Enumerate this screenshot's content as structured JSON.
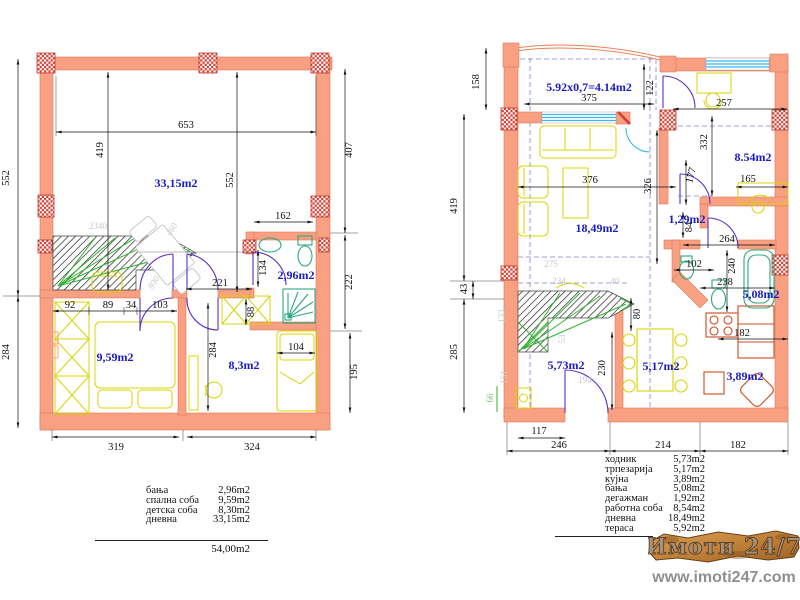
{
  "left": {
    "rooms": {
      "living": "33,15m2",
      "bath": "2,96m2",
      "bedroom": "9,59m2",
      "kids": "8,3m2"
    },
    "dims": {
      "w653": "653",
      "h419": "419",
      "h552a": "552",
      "h552b": "552",
      "h407": "407",
      "w162": "162",
      "h134": "134",
      "w221": "221",
      "h222": "222",
      "w92": "92",
      "w89": "89",
      "w34": "34",
      "w103": "103",
      "h88": "88",
      "h284a": "284",
      "h284b": "284",
      "w104": "104",
      "h195": "195",
      "w319": "319",
      "w324": "324"
    },
    "faint": {
      "f2340": "2340",
      "f460": "460",
      "f890": "890"
    },
    "legend": {
      "rows": [
        {
          "label": "бања",
          "value": "2,96m2"
        },
        {
          "label": "спална соба",
          "value": "9,59m2"
        },
        {
          "label": "детска соба",
          "value": "8,30m2"
        },
        {
          "label": "дневна",
          "value": "33,15m2"
        }
      ],
      "total": "54,00m2"
    }
  },
  "right": {
    "rooms": {
      "terrace": "5.92x0,7=4.14m2",
      "living": "18,49m2",
      "office": "8.54m2",
      "lobby": "1,29m2",
      "bath": "5,08m2",
      "kitchen": "3,89m2",
      "dining": "5,17m2",
      "hall": "5,73m2"
    },
    "dims": {
      "h158": "158",
      "w375": "375",
      "h122": "122",
      "w257": "257",
      "h332": "332",
      "h419": "419",
      "h43": "43",
      "h285": "285",
      "h66": "66",
      "w376": "376",
      "h326": "326",
      "h177": "177",
      "w165": "165",
      "h84": "84",
      "w264": "264",
      "w102": "102",
      "h240": "240",
      "w238": "238",
      "w182k": "182",
      "h80": "80",
      "h230": "230",
      "w117": "117",
      "w246": "246",
      "w214": "214",
      "w182b": "182"
    },
    "faint": {
      "f275": "275",
      "f234": "234",
      "f40": "40",
      "f133": "133",
      "f151": "151",
      "f53": "53",
      "f194": "194"
    },
    "legend": {
      "rows": [
        {
          "label": "ходник",
          "value": "5,73m2"
        },
        {
          "label": "трпезарија",
          "value": "5,17m2"
        },
        {
          "label": "кујна",
          "value": "3,89m2"
        },
        {
          "label": "бања",
          "value": "5,08m2"
        },
        {
          "label": "дегажман",
          "value": "1,92m2"
        },
        {
          "label": "работна соба",
          "value": "8,54m2"
        },
        {
          "label": "дневна",
          "value": "18,49m2"
        },
        {
          "label": "тераса",
          "value": "5,92m2"
        }
      ]
    }
  },
  "watermark": {
    "brand": "Имоти 24/7",
    "site": "www.imoti247.com"
  },
  "colors": {
    "wall": "#f9a083",
    "column": "#d23b2e",
    "room_label": "#1c1cc4",
    "furniture": "#d8d400",
    "sanitary": "#2aa87e",
    "door": "#5b2fc9",
    "window": "#3ab7ea",
    "kitchen": "#cc4b20",
    "stairs_arrow": "#2db52d"
  }
}
